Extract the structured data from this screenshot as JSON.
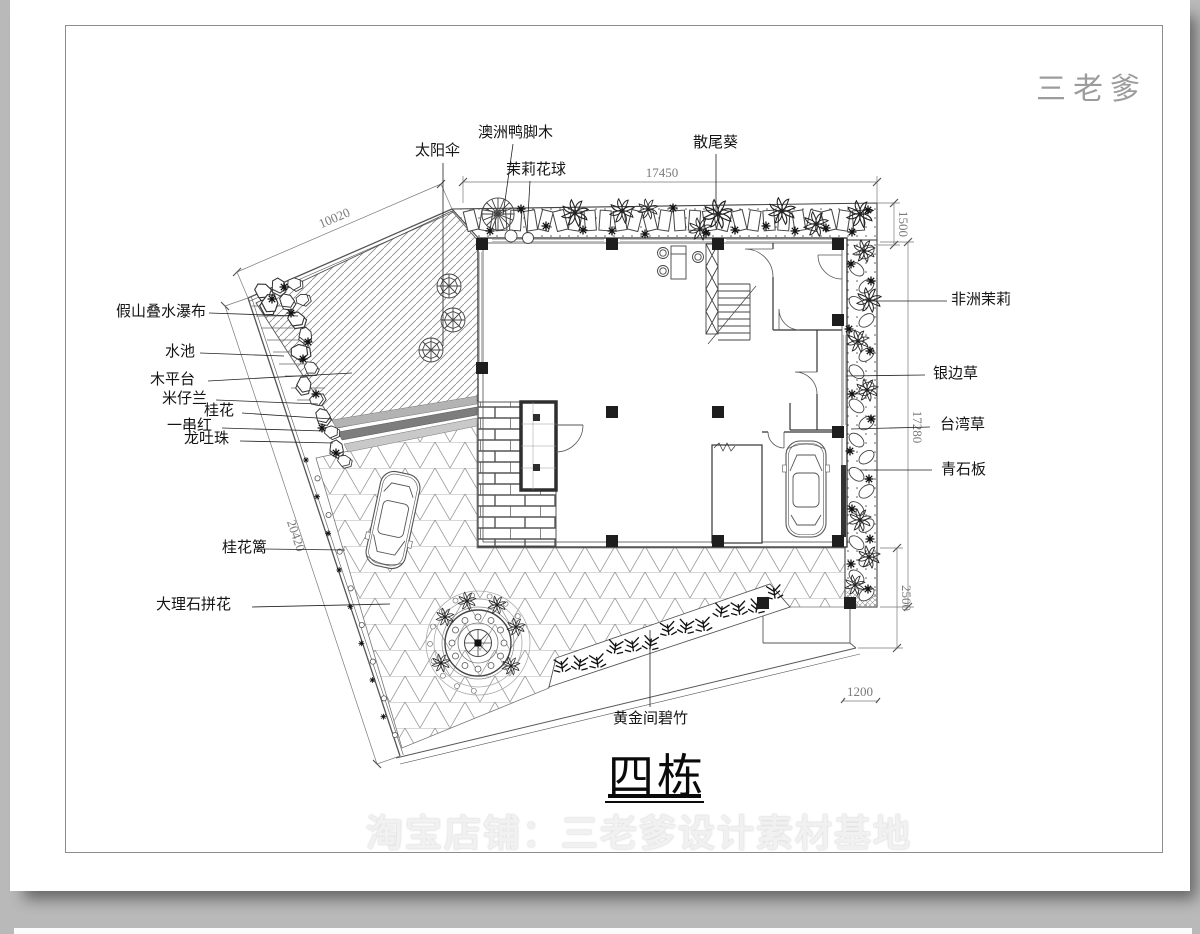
{
  "page": {
    "logo": "三老爹",
    "watermark": "淘宝店铺：三老爹设计素材基地",
    "title": "四栋"
  },
  "labels": {
    "sun_umbrella": "太阳伞",
    "australian_schefflera": "澳洲鸭脚木",
    "jasmine_ball": "茉莉花球",
    "areca_palm": "散尾葵",
    "rockery_waterfall": "假山叠水瀑布",
    "pool": "水池",
    "wood_deck": "木平台",
    "aglaia": "米仔兰",
    "osmanthus": "桂花",
    "scarlet_sage": "一串红",
    "bleeding_heart_vine": "龙吐珠",
    "osmanthus_hedge": "桂花篱",
    "marble_mosaic": "大理石拼花",
    "golden_bamboo": "黄金间碧竹",
    "african_jasmine": "非洲茉莉",
    "silver_edge_grass": "银边草",
    "taiwan_grass": "台湾草",
    "bluestone_slab": "青石板"
  },
  "dimensions": {
    "top": "17450",
    "top_left": "10020",
    "left": "20420",
    "right_top": "1500",
    "right_middle": "17280",
    "right_bottom": "2500",
    "bottom_right": "1200"
  }
}
